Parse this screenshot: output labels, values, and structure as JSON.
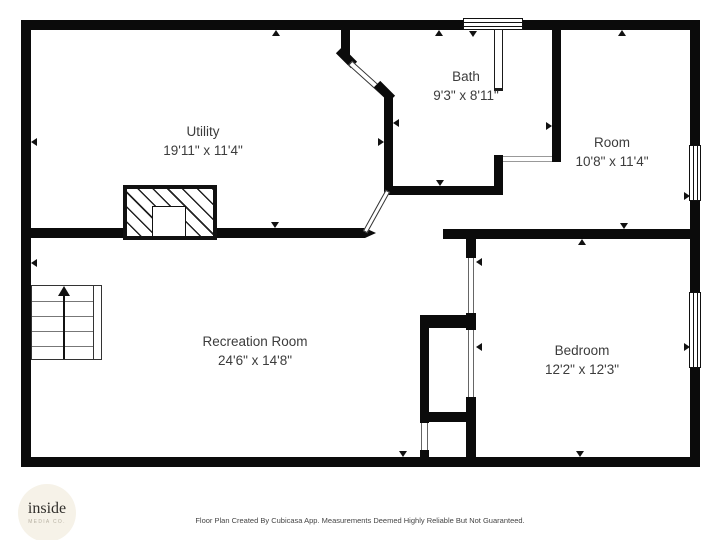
{
  "plan": {
    "title": "Basement floor plan",
    "rooms": [
      {
        "id": "utility",
        "name": "Utility",
        "dims": "19'11\" x 11'4\""
      },
      {
        "id": "bath",
        "name": "Bath",
        "dims": "9'3\" x 8'11\""
      },
      {
        "id": "room",
        "name": "Room",
        "dims": "10'8\" x 11'4\""
      },
      {
        "id": "recreation",
        "name": "Recreation Room",
        "dims": "24'6\" x 14'8\""
      },
      {
        "id": "bedroom",
        "name": "Bedroom",
        "dims": "12'2\" x 12'3\""
      }
    ],
    "features": [
      "stairs-up",
      "chimney",
      "shower-partition",
      "windows"
    ],
    "colors": {
      "wall": "#0b0b0b",
      "room_text": "#3c3c3c",
      "footer_text": "#454545",
      "logo_background": "#f6f2e8",
      "logo_text": "#32302c",
      "logo_subtext": "#b7b1a3"
    }
  },
  "branding": {
    "logo_line1": "inside",
    "logo_line2": "MEDIA CO."
  },
  "footer": {
    "disclaimer": "Floor Plan Created By Cubicasa App. Measurements Deemed Highly Reliable But Not Guaranteed."
  }
}
